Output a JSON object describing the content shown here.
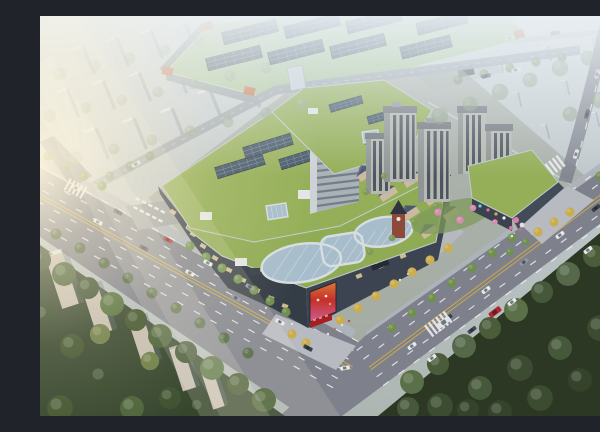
{
  "meta": {
    "label": "aerial-architectural-rendering"
  },
  "palette": {
    "sky-top": "#ccd3d8",
    "sky-mid": "#bdc6c9",
    "sky-low": "#b4bcba",
    "green-roof": "#94af58",
    "green-roof-2": "#8fab54",
    "industrial-roof": "#a9c69a",
    "solar-dark": "#425466",
    "solar-line": "#7d95a8",
    "orange": "#c4714b",
    "road": "#7e818c",
    "road-edge": "#6f727e",
    "sidewalk": "#aeb3bb",
    "plaza": "#b7bac1",
    "lane-white": "#eceef1",
    "lane-yellow": "#c9a84d",
    "forest-base": "#2c3823",
    "tree-bright": "#6f8f4f",
    "tree-yellow": "#c9ad4e",
    "bg-slab": "#c2ccd3",
    "bg-slab-warm": "#c6beb2",
    "facade-dark": "#343c46",
    "facade-dark-2": "#3b4450",
    "glass": "#a7bdcb",
    "frame": "#d6dee2",
    "tower-wall": "#b6b8b1",
    "tower-shade": "#8f9594",
    "tower-win": "#4c5661",
    "office-face": "#aab2b8",
    "office-side": "#cdd2d6",
    "office-lines": "#6b757e",
    "brick": "#8d4a38",
    "slate": "#4b5870",
    "slate-light": "#5d6b85",
    "wall-cream": "#cbb9a2",
    "hvac": "#e2e6e8",
    "sun": "#fff3da",
    "led-red": "#c4302a",
    "led-orange": "#e07838",
    "led-pink": "#cf5f92"
  },
  "vegetation": {
    "trees": [
      {
        "x": 20,
        "y": 58,
        "r": 7,
        "c": "#93a68e",
        "o": 0.55
      },
      {
        "x": 55,
        "y": 50,
        "r": 6,
        "c": "#93a68e",
        "o": 0.55
      },
      {
        "x": 90,
        "y": 42,
        "r": 6,
        "c": "#93a68e",
        "o": 0.55
      },
      {
        "x": 125,
        "y": 34,
        "r": 6,
        "c": "#93a68e",
        "o": 0.55
      },
      {
        "x": 160,
        "y": 26,
        "r": 6,
        "c": "#93a68e",
        "o": 0.55
      },
      {
        "x": 10,
        "y": 100,
        "r": 7,
        "c": "#93a68e",
        "o": 0.55
      },
      {
        "x": 46,
        "y": 92,
        "r": 6,
        "c": "#93a68e",
        "o": 0.55
      },
      {
        "x": 82,
        "y": 84,
        "r": 6,
        "c": "#93a68e",
        "o": 0.55
      },
      {
        "x": 118,
        "y": 76,
        "r": 6,
        "c": "#93a68e",
        "o": 0.55
      },
      {
        "x": 154,
        "y": 68,
        "r": 6,
        "c": "#93a68e",
        "o": 0.55
      },
      {
        "x": 190,
        "y": 60,
        "r": 6,
        "c": "#93a68e",
        "o": 0.55
      },
      {
        "x": 226,
        "y": 52,
        "r": 6,
        "c": "#93a68e",
        "o": 0.55
      },
      {
        "x": 36,
        "y": 142,
        "r": 7,
        "c": "#93a68e",
        "o": 0.6
      },
      {
        "x": 74,
        "y": 133,
        "r": 6,
        "c": "#93a68e",
        "o": 0.6
      },
      {
        "x": 112,
        "y": 124,
        "r": 6,
        "c": "#93a68e",
        "o": 0.6
      },
      {
        "x": 150,
        "y": 115,
        "r": 6,
        "c": "#93a68e",
        "o": 0.6
      },
      {
        "x": 188,
        "y": 106,
        "r": 6,
        "c": "#93a68e",
        "o": 0.6
      },
      {
        "x": 226,
        "y": 97,
        "r": 6,
        "c": "#93a68e",
        "o": 0.6
      },
      {
        "x": 262,
        "y": 88,
        "r": 6,
        "c": "#93a68e",
        "o": 0.6
      },
      {
        "x": 70,
        "y": 160,
        "r": 5,
        "c": "#7e9472",
        "o": 0.8
      },
      {
        "x": 90,
        "y": 150,
        "r": 5,
        "c": "#7e9472",
        "o": 0.8
      },
      {
        "x": 110,
        "y": 140,
        "r": 5,
        "c": "#7e9472",
        "o": 0.8
      },
      {
        "x": 418,
        "y": 64,
        "r": 5,
        "c": "#7e9472",
        "o": 0.8
      },
      {
        "x": 444,
        "y": 58,
        "r": 5,
        "c": "#7e9472",
        "o": 0.8
      },
      {
        "x": 470,
        "y": 52,
        "r": 5,
        "c": "#7e9472",
        "o": 0.8
      },
      {
        "x": 496,
        "y": 46,
        "r": 5,
        "c": "#7e9472",
        "o": 0.8
      },
      {
        "x": 522,
        "y": 41,
        "r": 5,
        "c": "#7e9472",
        "o": 0.8
      },
      {
        "x": 400,
        "y": 100,
        "r": 9,
        "c": "#8a9e85",
        "o": 0.6
      },
      {
        "x": 430,
        "y": 88,
        "r": 8,
        "c": "#8a9e85",
        "o": 0.6
      },
      {
        "x": 460,
        "y": 76,
        "r": 9,
        "c": "#8a9e85",
        "o": 0.6
      },
      {
        "x": 490,
        "y": 64,
        "r": 8,
        "c": "#8a9e85",
        "o": 0.6
      },
      {
        "x": 520,
        "y": 52,
        "r": 9,
        "c": "#8a9e85",
        "o": 0.6
      },
      {
        "x": 548,
        "y": 42,
        "r": 8,
        "c": "#8a9e85",
        "o": 0.6
      },
      {
        "x": 575,
        "y": 34,
        "r": 8,
        "c": "#8a9e85",
        "o": 0.6
      },
      {
        "x": 595,
        "y": 60,
        "r": 9,
        "c": "#8a9e85",
        "o": 0.6
      },
      {
        "x": 560,
        "y": 84,
        "r": 9,
        "c": "#8a9e85",
        "o": 0.6
      },
      {
        "x": 530,
        "y": 98,
        "r": 8,
        "c": "#8a9e85",
        "o": 0.6
      },
      {
        "x": 590,
        "y": 110,
        "r": 10,
        "c": "#8a9e85",
        "o": 0.65
      },
      {
        "x": 575,
        "y": 130,
        "r": 9,
        "c": "#8a9e85",
        "o": 0.65
      },
      {
        "x": 8,
        "y": 140,
        "r": 5,
        "c": "#6f8f4f"
      },
      {
        "x": 26,
        "y": 150,
        "r": 5,
        "c": "#6f8f4f"
      },
      {
        "x": 44,
        "y": 160,
        "r": 5,
        "c": "#6f8f4f"
      },
      {
        "x": 62,
        "y": 170,
        "r": 5,
        "c": "#6f8f4f"
      },
      {
        "x": 150,
        "y": 230,
        "r": 5,
        "c": "#6f8f4f"
      },
      {
        "x": 166,
        "y": 241,
        "r": 5,
        "c": "#6f8f4f"
      },
      {
        "x": 182,
        "y": 252,
        "r": 5,
        "c": "#6f8f4f"
      },
      {
        "x": 198,
        "y": 263,
        "r": 5,
        "c": "#6f8f4f"
      },
      {
        "x": 214,
        "y": 274,
        "r": 5,
        "c": "#6f8f4f"
      },
      {
        "x": 230,
        "y": 285,
        "r": 5,
        "c": "#6f8f4f"
      },
      {
        "x": 246,
        "y": 296,
        "r": 5,
        "c": "#6f8f4f"
      },
      {
        "x": 16,
        "y": 218,
        "r": 6,
        "c": "#4e6440"
      },
      {
        "x": 40,
        "y": 232,
        "r": 6,
        "c": "#4e6440"
      },
      {
        "x": 64,
        "y": 247,
        "r": 6,
        "c": "#4e6440"
      },
      {
        "x": 88,
        "y": 262,
        "r": 6,
        "c": "#4e6440"
      },
      {
        "x": 112,
        "y": 277,
        "r": 6,
        "c": "#4e6440"
      },
      {
        "x": 136,
        "y": 292,
        "r": 6,
        "c": "#4e6440"
      },
      {
        "x": 160,
        "y": 307,
        "r": 6,
        "c": "#4e6440"
      },
      {
        "x": 184,
        "y": 322,
        "r": 6,
        "c": "#4e6440"
      },
      {
        "x": 208,
        "y": 337,
        "r": 6,
        "c": "#4e6440"
      },
      {
        "x": 0,
        "y": 244,
        "r": 12,
        "c": "#3d5030"
      },
      {
        "x": 24,
        "y": 258,
        "r": 13,
        "c": "#4c6339"
      },
      {
        "x": 48,
        "y": 272,
        "r": 12,
        "c": "#3d5030"
      },
      {
        "x": 72,
        "y": 288,
        "r": 13,
        "c": "#54703f"
      },
      {
        "x": 96,
        "y": 304,
        "r": 12,
        "c": "#42552f"
      },
      {
        "x": 120,
        "y": 320,
        "r": 13,
        "c": "#4c6339"
      },
      {
        "x": 146,
        "y": 336,
        "r": 12,
        "c": "#3d5030"
      },
      {
        "x": 172,
        "y": 352,
        "r": 13,
        "c": "#54703f"
      },
      {
        "x": 198,
        "y": 368,
        "r": 12,
        "c": "#42552f"
      },
      {
        "x": 224,
        "y": 384,
        "r": 13,
        "c": "#4c6339"
      },
      {
        "x": 4,
        "y": 300,
        "r": 14,
        "c": "#35472a"
      },
      {
        "x": 32,
        "y": 330,
        "r": 13,
        "c": "#42552f"
      },
      {
        "x": 62,
        "y": 362,
        "r": 14,
        "c": "#35472a"
      },
      {
        "x": 92,
        "y": 392,
        "r": 13,
        "c": "#4c6339"
      },
      {
        "x": 130,
        "y": 382,
        "r": 12,
        "c": "#3d5030"
      },
      {
        "x": 20,
        "y": 392,
        "r": 14,
        "c": "#42552f"
      },
      {
        "x": 160,
        "y": 392,
        "r": 12,
        "c": "#35472a"
      },
      {
        "x": 60,
        "y": 318,
        "r": 11,
        "c": "#6e7e48"
      },
      {
        "x": 110,
        "y": 345,
        "r": 10,
        "c": "#6e7e48"
      },
      {
        "x": 352,
        "y": 312,
        "r": 5,
        "c": "#6f8f4f"
      },
      {
        "x": 372,
        "y": 297,
        "r": 5,
        "c": "#6f8f4f"
      },
      {
        "x": 392,
        "y": 282,
        "r": 5,
        "c": "#6f8f4f"
      },
      {
        "x": 412,
        "y": 267,
        "r": 5,
        "c": "#6f8f4f"
      },
      {
        "x": 432,
        "y": 252,
        "r": 5,
        "c": "#6f8f4f"
      },
      {
        "x": 452,
        "y": 237,
        "r": 5,
        "c": "#6f8f4f"
      },
      {
        "x": 472,
        "y": 222,
        "r": 5,
        "c": "#6f8f4f"
      },
      {
        "x": 560,
        "y": 160,
        "r": 5,
        "c": "#6f8f4f"
      },
      {
        "x": 578,
        "y": 147,
        "r": 5,
        "c": "#6f8f4f"
      },
      {
        "x": 372,
        "y": 366,
        "r": 13,
        "c": "#5a7048"
      },
      {
        "x": 398,
        "y": 348,
        "r": 12,
        "c": "#4a5c3a"
      },
      {
        "x": 424,
        "y": 330,
        "r": 13,
        "c": "#55694a"
      },
      {
        "x": 450,
        "y": 312,
        "r": 12,
        "c": "#4a5c3a"
      },
      {
        "x": 476,
        "y": 294,
        "r": 13,
        "c": "#5a7048"
      },
      {
        "x": 502,
        "y": 276,
        "r": 12,
        "c": "#46583a"
      },
      {
        "x": 528,
        "y": 258,
        "r": 13,
        "c": "#55694a"
      },
      {
        "x": 554,
        "y": 240,
        "r": 12,
        "c": "#4a5c3a"
      },
      {
        "x": 580,
        "y": 222,
        "r": 13,
        "c": "#5a7048"
      },
      {
        "x": 596,
        "y": 205,
        "r": 11,
        "c": "#46583a"
      },
      {
        "x": 400,
        "y": 390,
        "r": 14,
        "c": "#3c4c30"
      },
      {
        "x": 440,
        "y": 372,
        "r": 13,
        "c": "#46583a"
      },
      {
        "x": 480,
        "y": 352,
        "r": 14,
        "c": "#3c4c30"
      },
      {
        "x": 520,
        "y": 332,
        "r": 13,
        "c": "#46583a"
      },
      {
        "x": 560,
        "y": 312,
        "r": 14,
        "c": "#3c4c30"
      },
      {
        "x": 592,
        "y": 292,
        "r": 13,
        "c": "#46583a"
      },
      {
        "x": 460,
        "y": 396,
        "r": 13,
        "c": "#35432a"
      },
      {
        "x": 500,
        "y": 382,
        "r": 14,
        "c": "#3c4c30"
      },
      {
        "x": 540,
        "y": 364,
        "r": 13,
        "c": "#35432a"
      },
      {
        "x": 580,
        "y": 346,
        "r": 14,
        "c": "#3c4c30"
      },
      {
        "x": 428,
        "y": 394,
        "r": 12,
        "c": "#35432a"
      },
      {
        "x": 368,
        "y": 392,
        "r": 12,
        "c": "#46583a"
      },
      {
        "x": 596,
        "y": 252,
        "r": 10,
        "c": "#55694a"
      },
      {
        "x": 572,
        "y": 270,
        "r": 11,
        "c": "#46583a"
      },
      {
        "x": 300,
        "y": 304,
        "r": 5,
        "c": "#c9ad4e"
      },
      {
        "x": 318,
        "y": 292,
        "r": 5,
        "c": "#c9ad4e"
      },
      {
        "x": 336,
        "y": 280,
        "r": 5,
        "c": "#c9ad4e"
      },
      {
        "x": 354,
        "y": 268,
        "r": 5,
        "c": "#c9ad4e"
      },
      {
        "x": 372,
        "y": 256,
        "r": 5,
        "c": "#c9ad4e"
      },
      {
        "x": 390,
        "y": 244,
        "r": 5,
        "c": "#c9ad4e"
      },
      {
        "x": 408,
        "y": 232,
        "r": 5,
        "c": "#c9ad4e"
      },
      {
        "x": 498,
        "y": 216,
        "r": 5,
        "c": "#c9ad4e"
      },
      {
        "x": 514,
        "y": 206,
        "r": 5,
        "c": "#c9ad4e"
      },
      {
        "x": 530,
        "y": 196,
        "r": 5,
        "c": "#c9ad4e"
      },
      {
        "x": 252,
        "y": 318,
        "r": 5,
        "c": "#c9ad4e"
      },
      {
        "x": 266,
        "y": 327,
        "r": 5,
        "c": "#c9ad4e"
      },
      {
        "x": 398,
        "y": 196,
        "r": 4,
        "c": "#d98cb0"
      },
      {
        "x": 420,
        "y": 204,
        "r": 4,
        "c": "#d98cb0"
      },
      {
        "x": 433,
        "y": 192,
        "r": 3.5,
        "c": "#d98cb0"
      },
      {
        "x": 455,
        "y": 206,
        "r": 3,
        "c": "#d98cb0"
      },
      {
        "x": 330,
        "y": 236,
        "r": 3.5,
        "c": "#7f9a5a"
      },
      {
        "x": 352,
        "y": 222,
        "r": 3.5,
        "c": "#7f9a5a"
      },
      {
        "x": 374,
        "y": 206,
        "r": 3.5,
        "c": "#7f9a5a"
      },
      {
        "x": 396,
        "y": 190,
        "r": 3.5,
        "c": "#7f9a5a"
      },
      {
        "x": 326,
        "y": 176,
        "r": 3.5,
        "c": "#7f9a5a"
      },
      {
        "x": 344,
        "y": 160,
        "r": 3.5,
        "c": "#7f9a5a"
      },
      {
        "x": 486,
        "y": 226,
        "r": 4,
        "c": "#6f8f4f"
      },
      {
        "x": 470,
        "y": 236,
        "r": 4,
        "c": "#6f8f4f"
      }
    ]
  },
  "vehicles": [
    {
      "x": 36,
      "y": 172,
      "a": 29,
      "c": "#e8eaec"
    },
    {
      "x": 78,
      "y": 196,
      "a": 29,
      "c": "#3a414c"
    },
    {
      "x": 128,
      "y": 224,
      "a": 29,
      "c": "#b8343a"
    },
    {
      "x": 168,
      "y": 247,
      "a": 29,
      "c": "#e8eaec"
    },
    {
      "x": 210,
      "y": 271,
      "a": 29,
      "c": "#8f969e"
    },
    {
      "x": 58,
      "y": 206,
      "a": 29,
      "c": "#e8eaec"
    },
    {
      "x": 104,
      "y": 232,
      "a": 29,
      "c": "#444b55"
    },
    {
      "x": 150,
      "y": 257,
      "a": 29,
      "c": "#e8eaec"
    },
    {
      "x": 196,
      "y": 282,
      "a": 29,
      "c": "#8f969e"
    },
    {
      "x": 240,
      "y": 306,
      "a": 29,
      "c": "#e8eaec"
    },
    {
      "x": 268,
      "y": 332,
      "a": 29,
      "c": "#3a414c"
    },
    {
      "x": 305,
      "y": 352,
      "a": -10,
      "c": "#e8eaec"
    },
    {
      "x": 372,
      "y": 330,
      "a": -37,
      "c": "#e8eaec"
    },
    {
      "x": 408,
      "y": 302,
      "a": -37,
      "c": "#3a414c"
    },
    {
      "x": 446,
      "y": 274,
      "a": -37,
      "c": "#e8eaec"
    },
    {
      "x": 484,
      "y": 246,
      "a": -37,
      "c": "#8f969e"
    },
    {
      "x": 520,
      "y": 219,
      "a": -37,
      "c": "#e8eaec"
    },
    {
      "x": 556,
      "y": 192,
      "a": -37,
      "c": "#3a414c"
    },
    {
      "x": 392,
      "y": 342,
      "a": -37,
      "c": "#e8eaec"
    },
    {
      "x": 432,
      "y": 314,
      "a": -37,
      "c": "#444b55"
    },
    {
      "x": 472,
      "y": 286,
      "a": -37,
      "c": "#e8eaec"
    },
    {
      "x": 455,
      "y": 296,
      "a": -37,
      "c": "#b0262c",
      "s": 1.4
    },
    {
      "x": 548,
      "y": 234,
      "a": -37,
      "c": "#e8eaec"
    },
    {
      "x": 404,
      "y": 306,
      "a": -37,
      "c": "#dfe3e6",
      "s": 1.5
    },
    {
      "x": 536,
      "y": 138,
      "a": -72,
      "c": "#e8eaec",
      "o": 0.9
    },
    {
      "x": 547,
      "y": 98,
      "a": -74,
      "c": "#444b55",
      "o": 0.8
    },
    {
      "x": 557,
      "y": 58,
      "a": -76,
      "c": "#e8eaec",
      "o": 0.6
    },
    {
      "x": 96,
      "y": 148,
      "a": -28,
      "c": "#e8eaec",
      "o": 0.8
    },
    {
      "x": 446,
      "y": 60,
      "a": -12,
      "c": "#3a414c",
      "o": 0.7
    },
    {
      "x": 476,
      "y": 54,
      "a": -12,
      "c": "#e8eaec",
      "o": 0.7
    },
    {
      "x": 470,
      "y": 22,
      "a": -8,
      "c": "#e8eaec",
      "o": 0.55
    },
    {
      "x": 515,
      "y": 17,
      "a": -8,
      "c": "#444b55",
      "o": 0.55
    }
  ],
  "people": [
    {
      "x": 288,
      "y": 318,
      "c": "#e8e2d6"
    },
    {
      "x": 295,
      "y": 313,
      "c": "#c87850"
    },
    {
      "x": 302,
      "y": 309,
      "c": "#e8e2d6"
    },
    {
      "x": 309,
      "y": 305,
      "c": "#b04848"
    },
    {
      "x": 360,
      "y": 264,
      "c": "#e8e2d6"
    },
    {
      "x": 368,
      "y": 258,
      "c": "#d8c8b8"
    },
    {
      "x": 472,
      "y": 220,
      "c": "#e8e2d6"
    },
    {
      "x": 480,
      "y": 214,
      "c": "#c87850"
    },
    {
      "x": 252,
      "y": 308,
      "c": "#e8e2d6"
    },
    {
      "x": 226,
      "y": 292,
      "c": "#d8c8b8"
    }
  ]
}
